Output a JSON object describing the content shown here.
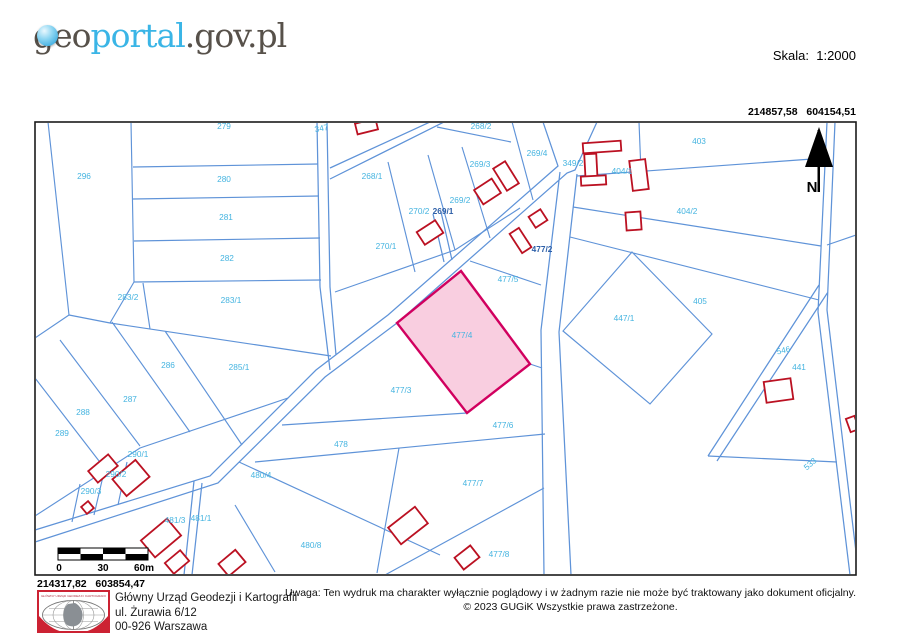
{
  "header": {
    "logo": {
      "geo": "geo",
      "portal": "portal",
      "suffix": ".gov.pl"
    },
    "scale_label": "Skala:  1:2000"
  },
  "map": {
    "coord_top_right": "214857,58   604154,51",
    "coord_bottom_left": "214317,82   603854,47",
    "north_label": "N",
    "scalebar_ticks": [
      "0",
      "30",
      "60m"
    ],
    "highlighted_parcel": "477/4",
    "colors": {
      "parcel_line": "#5f93d8",
      "parcel_label": "#45b4e0",
      "parcel_label_dark": "#2d5fa8",
      "building": "#bb1122",
      "highlight_fill": "#f8c6da",
      "highlight_stroke": "#d1005f"
    },
    "parcels": [
      {
        "id": "279",
        "x": 224,
        "y": 129
      },
      {
        "id": "347",
        "x": 322,
        "y": 131,
        "rot": -10
      },
      {
        "id": "268/2",
        "x": 481,
        "y": 129
      },
      {
        "id": "296",
        "x": 84,
        "y": 179
      },
      {
        "id": "280",
        "x": 224,
        "y": 182
      },
      {
        "id": "268/1",
        "x": 372,
        "y": 179
      },
      {
        "id": "269/4",
        "x": 537,
        "y": 156
      },
      {
        "id": "349/2",
        "x": 573,
        "y": 166
      },
      {
        "id": "269/3",
        "x": 480,
        "y": 167
      },
      {
        "id": "404/1",
        "x": 622,
        "y": 174
      },
      {
        "id": "403",
        "x": 699,
        "y": 144
      },
      {
        "id": "281",
        "x": 226,
        "y": 220
      },
      {
        "id": "269/2",
        "x": 460,
        "y": 203
      },
      {
        "id": "270/2",
        "x": 419,
        "y": 214
      },
      {
        "id": "269/1",
        "x": 443,
        "y": 214,
        "dark": true
      },
      {
        "id": "404/2",
        "x": 687,
        "y": 214
      },
      {
        "id": "282",
        "x": 227,
        "y": 261
      },
      {
        "id": "270/1",
        "x": 386,
        "y": 249
      },
      {
        "id": "477/2",
        "x": 542,
        "y": 252,
        "dark": true
      },
      {
        "id": "283/2",
        "x": 128,
        "y": 300
      },
      {
        "id": "283/1",
        "x": 231,
        "y": 303
      },
      {
        "id": "477/5",
        "x": 508,
        "y": 282
      },
      {
        "id": "405",
        "x": 700,
        "y": 304
      },
      {
        "id": "447/1",
        "x": 624,
        "y": 321
      },
      {
        "id": "477/4",
        "x": 462,
        "y": 338
      },
      {
        "id": "546",
        "x": 784,
        "y": 353,
        "rot": -12
      },
      {
        "id": "441",
        "x": 799,
        "y": 370
      },
      {
        "id": "286",
        "x": 168,
        "y": 368
      },
      {
        "id": "285/1",
        "x": 239,
        "y": 370
      },
      {
        "id": "287",
        "x": 130,
        "y": 402
      },
      {
        "id": "288",
        "x": 83,
        "y": 415
      },
      {
        "id": "477/3",
        "x": 401,
        "y": 393
      },
      {
        "id": "289",
        "x": 62,
        "y": 436
      },
      {
        "id": "477/6",
        "x": 503,
        "y": 428
      },
      {
        "id": "478",
        "x": 341,
        "y": 447
      },
      {
        "id": "290/1",
        "x": 138,
        "y": 457
      },
      {
        "id": "290/2",
        "x": 116,
        "y": 477
      },
      {
        "id": "480/4",
        "x": 261,
        "y": 478
      },
      {
        "id": "290/3",
        "x": 91,
        "y": 494
      },
      {
        "id": "477/7",
        "x": 473,
        "y": 486
      },
      {
        "id": "533",
        "x": 812,
        "y": 466,
        "rot": -42
      },
      {
        "id": "481/3",
        "x": 175,
        "y": 523
      },
      {
        "id": "481/1",
        "x": 201,
        "y": 521
      },
      {
        "id": "480/8",
        "x": 311,
        "y": 548
      },
      {
        "id": "477/8",
        "x": 499,
        "y": 557
      },
      {
        "id": "484",
        "x": 112,
        "y": 557
      }
    ]
  },
  "footer": {
    "logo_caption": "GŁÓWNY URZĄD GEODEZJI I KARTOGRAFII",
    "org_name": "Główny Urząd Geodezji i Kartografii",
    "org_addr1": "ul. Żurawia 6/12",
    "org_addr2": "00-926 Warszawa",
    "disclaimer": "Uwaga: Ten wydruk ma charakter wyłącznie poglądowy i w żadnym razie nie może być traktowany jako dokument oficjalny.",
    "copyright": "© 2023 GUGiK Wszystkie prawa zastrzeżone."
  }
}
